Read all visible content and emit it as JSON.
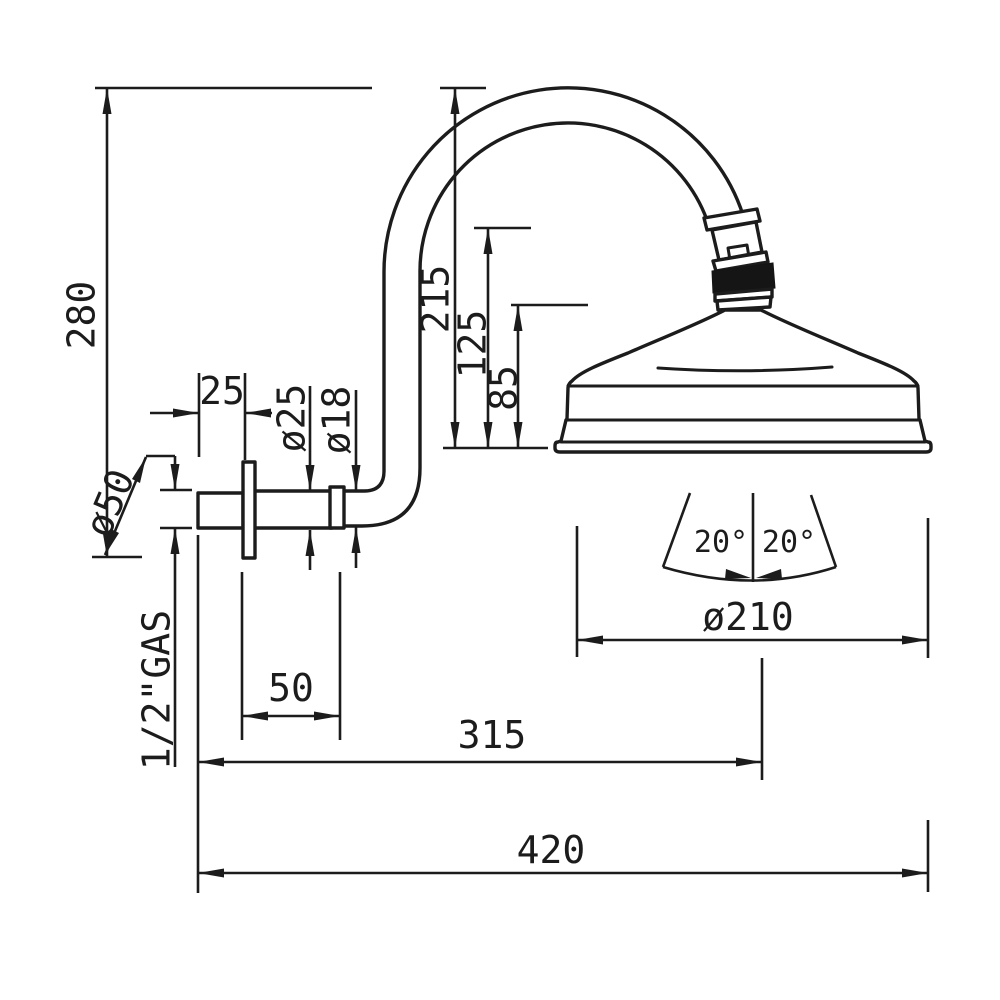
{
  "page": {
    "background": "#ffffff",
    "line_color": "#1c1c1c"
  },
  "drawing": {
    "kind": "technical-dimension-drawing",
    "subject": "wall-mounted shower head with curved gooseneck arm, side view",
    "dims": {
      "overall_height": "280",
      "arm_rise": "215",
      "joint_height": "125",
      "collar_height": "85",
      "wall_plate_offset": "25",
      "arm_od": "ø25",
      "arm_id": "ø18",
      "flange_diameter": "ø50",
      "thread": "1/2\"GAS",
      "flange_to_bend": "50",
      "wall_to_head_center": "315",
      "total_reach": "420",
      "head_diameter": "ø210",
      "swivel_angle_left": "20°",
      "swivel_angle_right": "20°"
    }
  }
}
